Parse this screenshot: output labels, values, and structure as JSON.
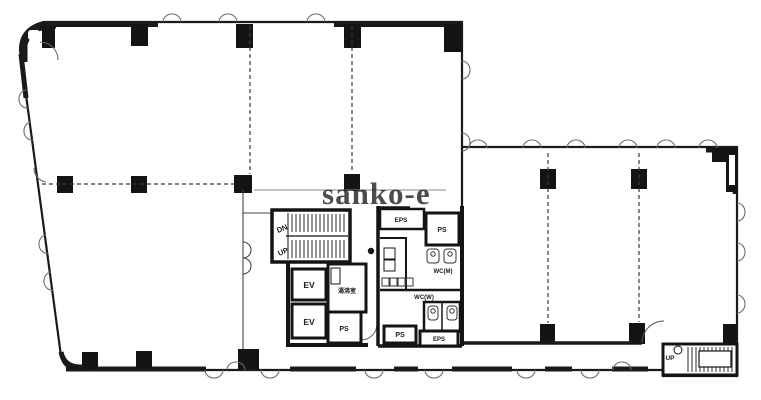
{
  "watermark": "sanko-e",
  "labels": {
    "stair_down": "DN",
    "stair_up": "UP",
    "elevator_1": "EV",
    "elevator_2": "EV",
    "kitchenette": "湯沸室",
    "ps_core": "PS",
    "eps_north": "EPS",
    "ps_north": "PS",
    "wc_men": "WC(M)",
    "wc_women": "WC(W)",
    "ps_south": "PS",
    "eps_south": "EPS",
    "exterior_stair_up": "UP"
  },
  "colors": {
    "wall": "#141414",
    "watermark_gray": "#8d8d8d",
    "background": "#ffffff",
    "dashed_line": "#3a3a3a"
  }
}
